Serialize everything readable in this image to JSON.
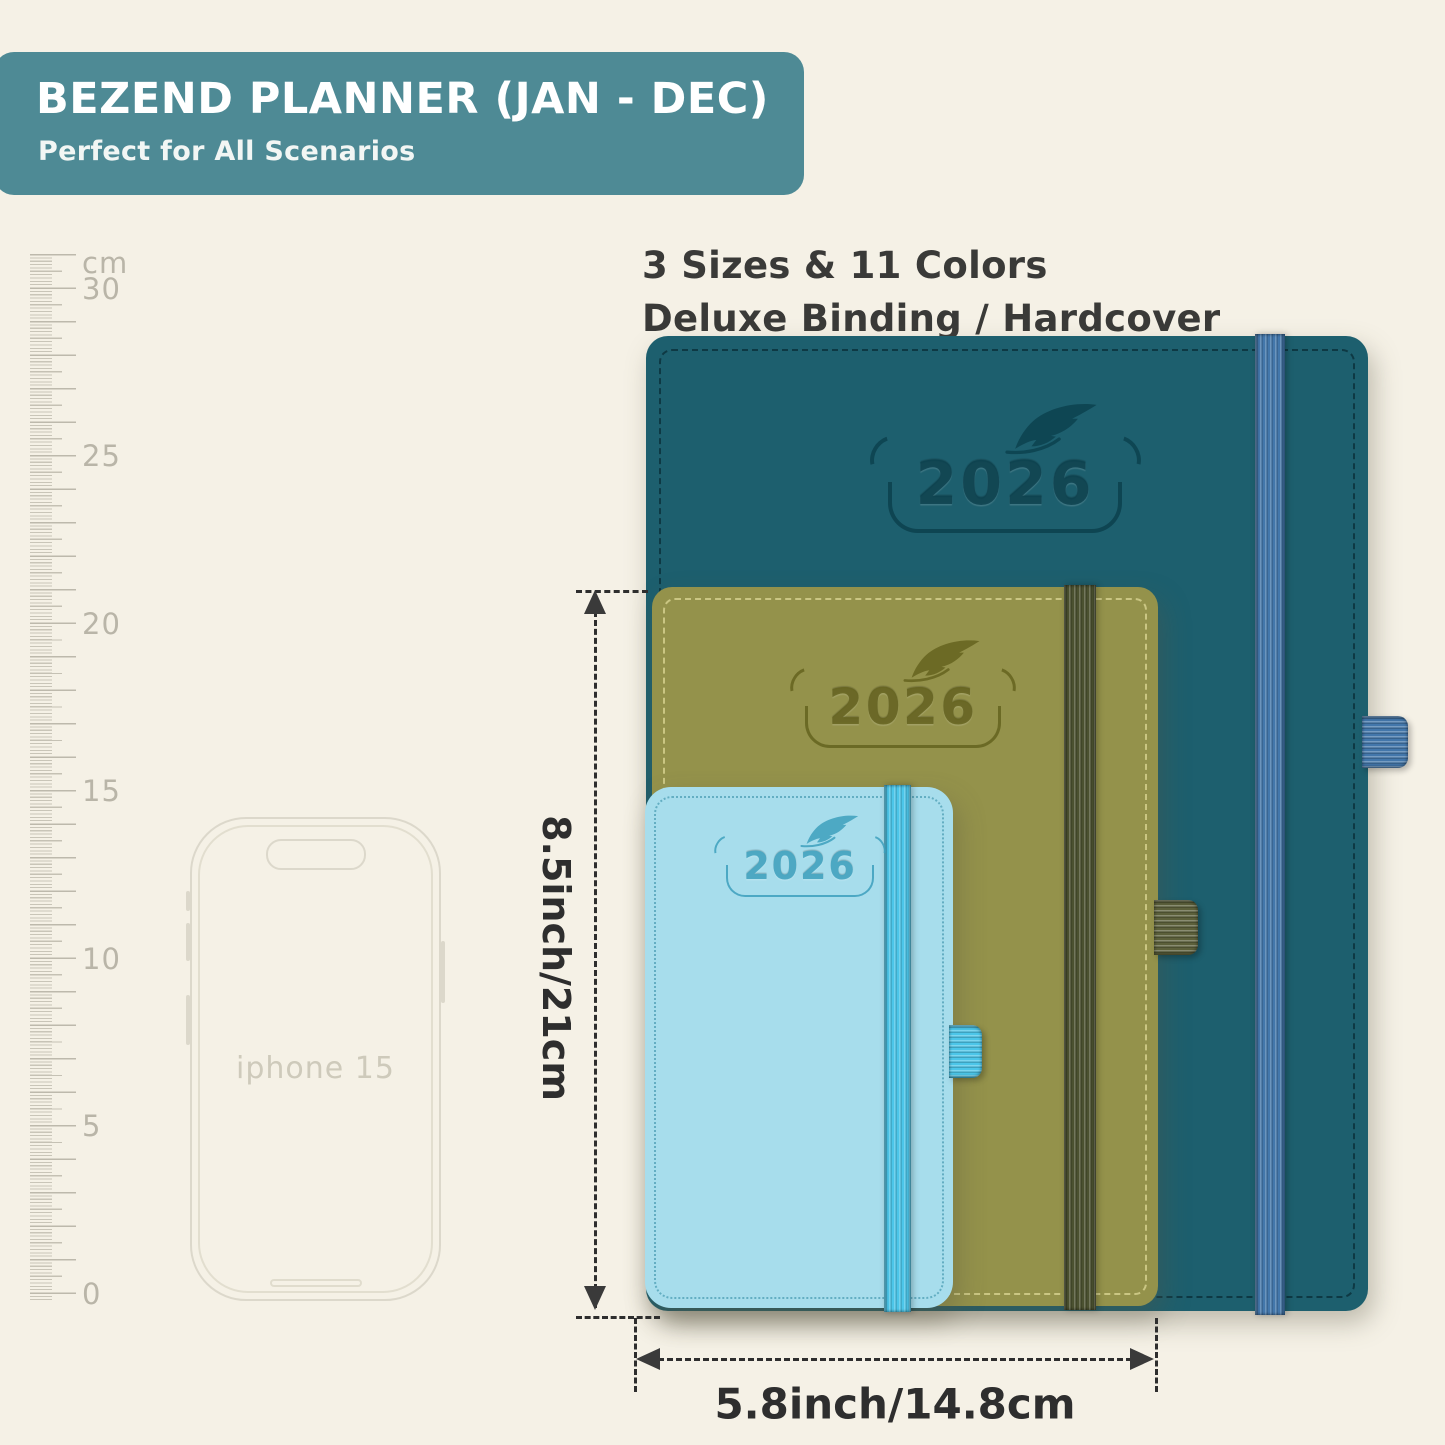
{
  "page": {
    "background_color": "#f5f1e6"
  },
  "header": {
    "title": "BEZEND PLANNER (JAN - DEC)",
    "subtitle": "Perfect for All Scenarios",
    "bg_color": "#4e8a95",
    "text_color": "#ffffff"
  },
  "info": {
    "line1": "3 Sizes & 11 Colors",
    "line2": "Deluxe Binding / Hardcover"
  },
  "ruler": {
    "labels": [
      "cm",
      "30",
      "25",
      "20",
      "15",
      "10",
      "5",
      "0"
    ],
    "tick_color": "#c5c1b4"
  },
  "phone": {
    "label": "iphone 15"
  },
  "planners": {
    "large": {
      "year": "2026",
      "cover_color": "#1d5f6e",
      "band_color": "#4377ab"
    },
    "medium": {
      "year": "2026",
      "cover_color": "#94924b",
      "band_color": "#4b5130"
    },
    "small": {
      "year": "2026",
      "cover_color": "#a7ddec",
      "band_color": "#4cc6e9"
    }
  },
  "dimensions": {
    "height_label": "8.5inch/21cm",
    "width_label": "5.8inch/14.8cm"
  }
}
